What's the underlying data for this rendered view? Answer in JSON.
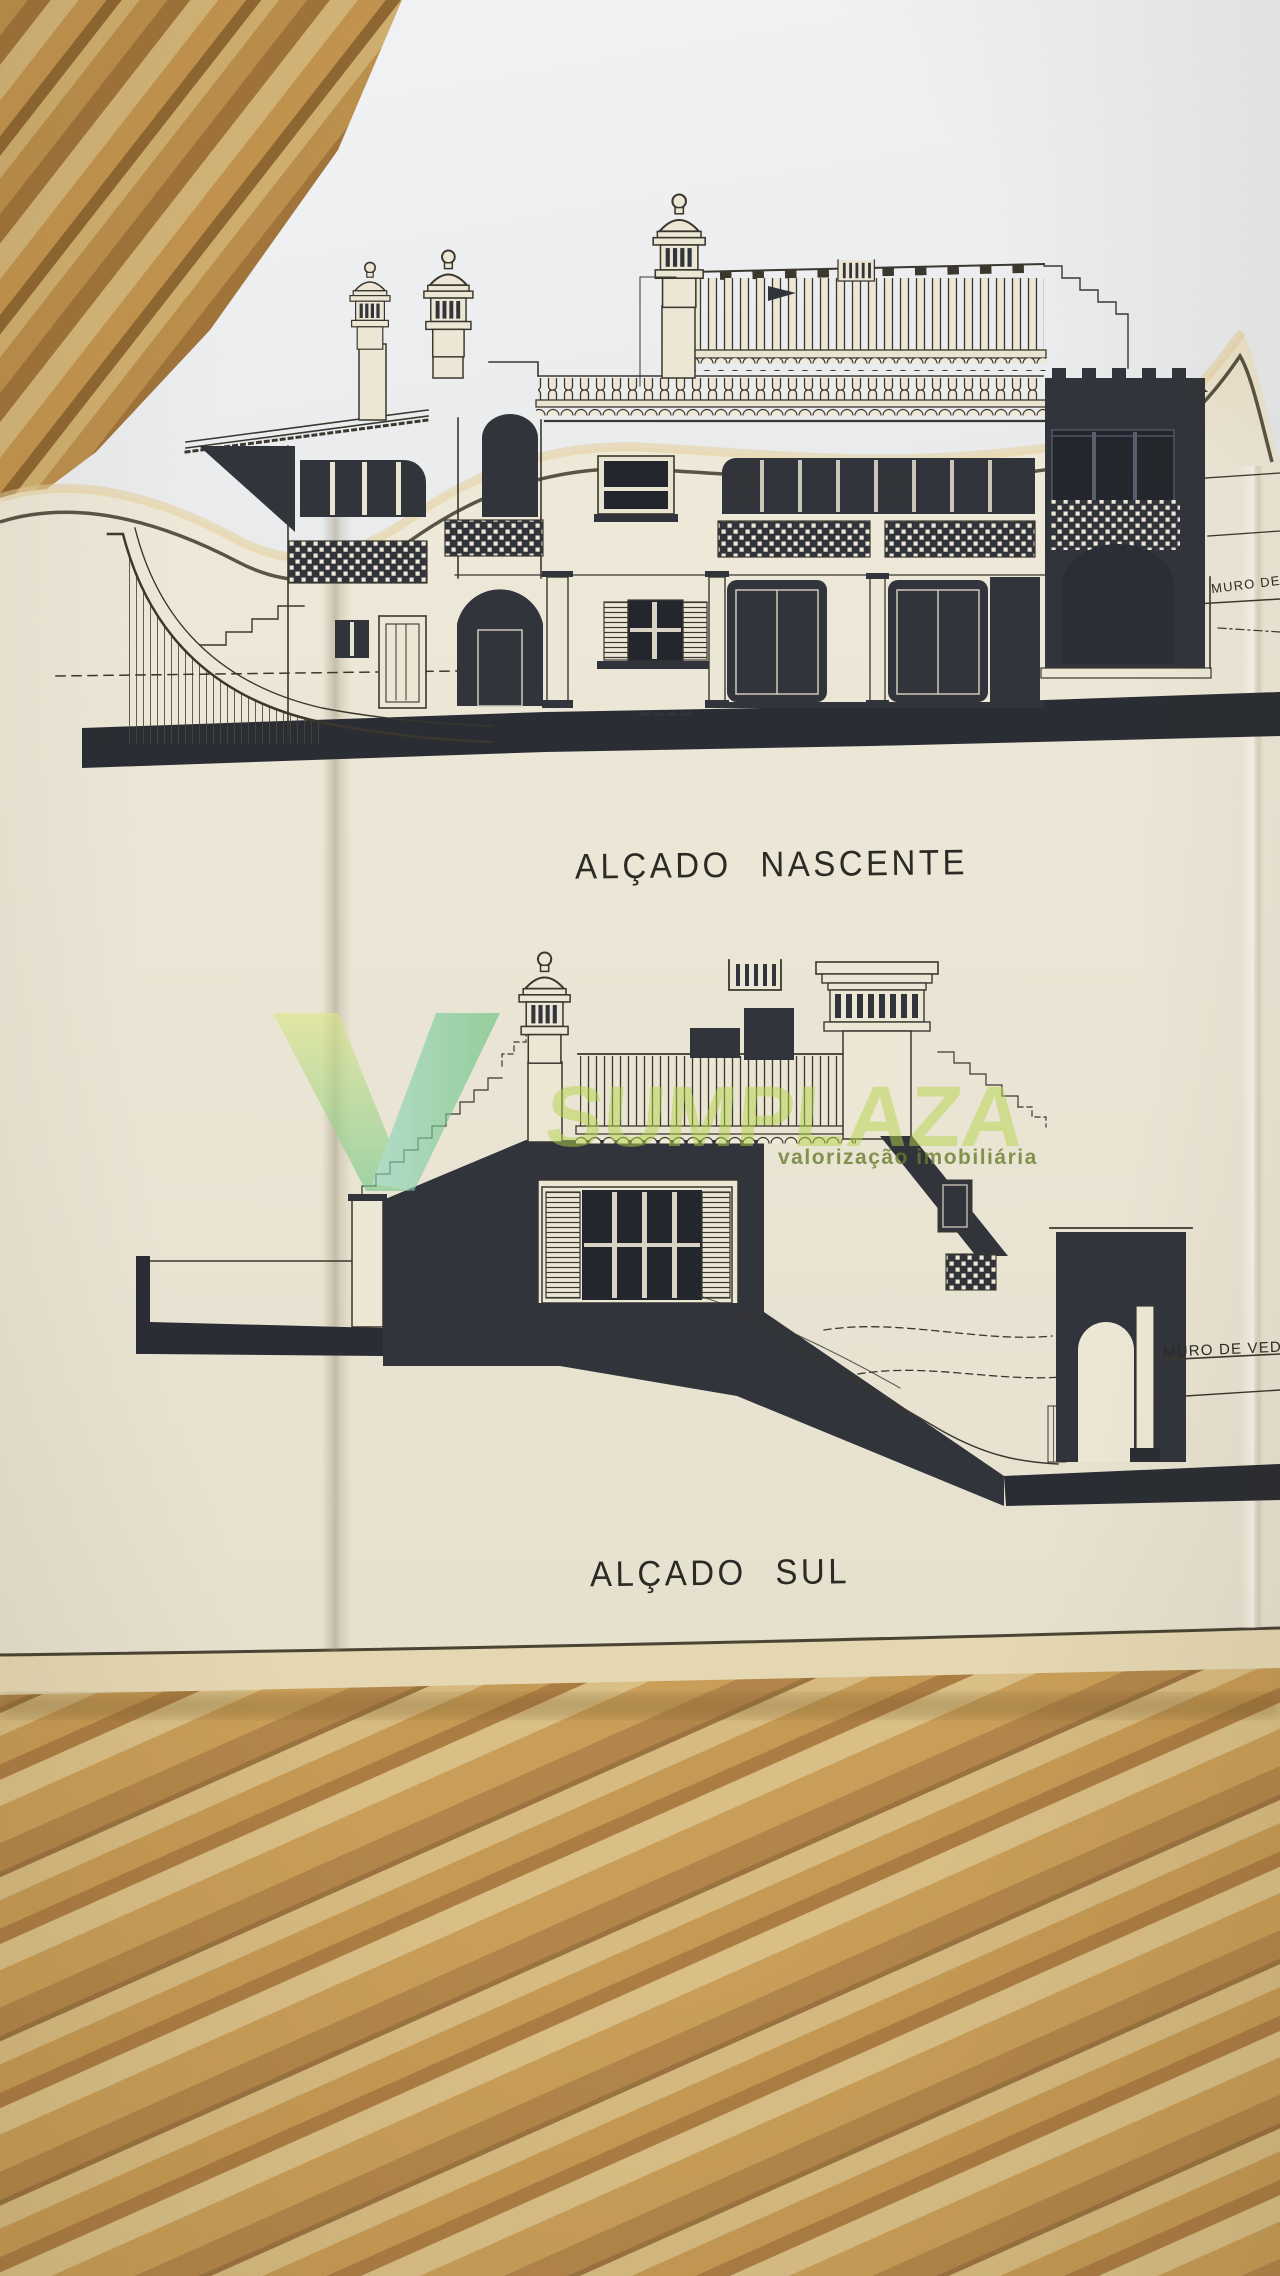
{
  "sheet": {
    "titles": {
      "east": "ALÇADO NASCENTE",
      "south": "ALÇADO SUL"
    },
    "labels": {
      "muro_top": "MURO DE",
      "muro_bottom": "MURO DE VEDA"
    }
  },
  "watermark": {
    "logo_letter": "V",
    "brand_text": "SUMPLAZA",
    "tagline": "valorização imobiliária",
    "green": "#a8c845",
    "teal": "#7fd3bd"
  },
  "colors": {
    "paper": "#ebe5d4",
    "ink": "#3a372e",
    "dark_fill": "#32343c",
    "wood": "#c89e58",
    "white_sheet": "#f1f2f4"
  }
}
